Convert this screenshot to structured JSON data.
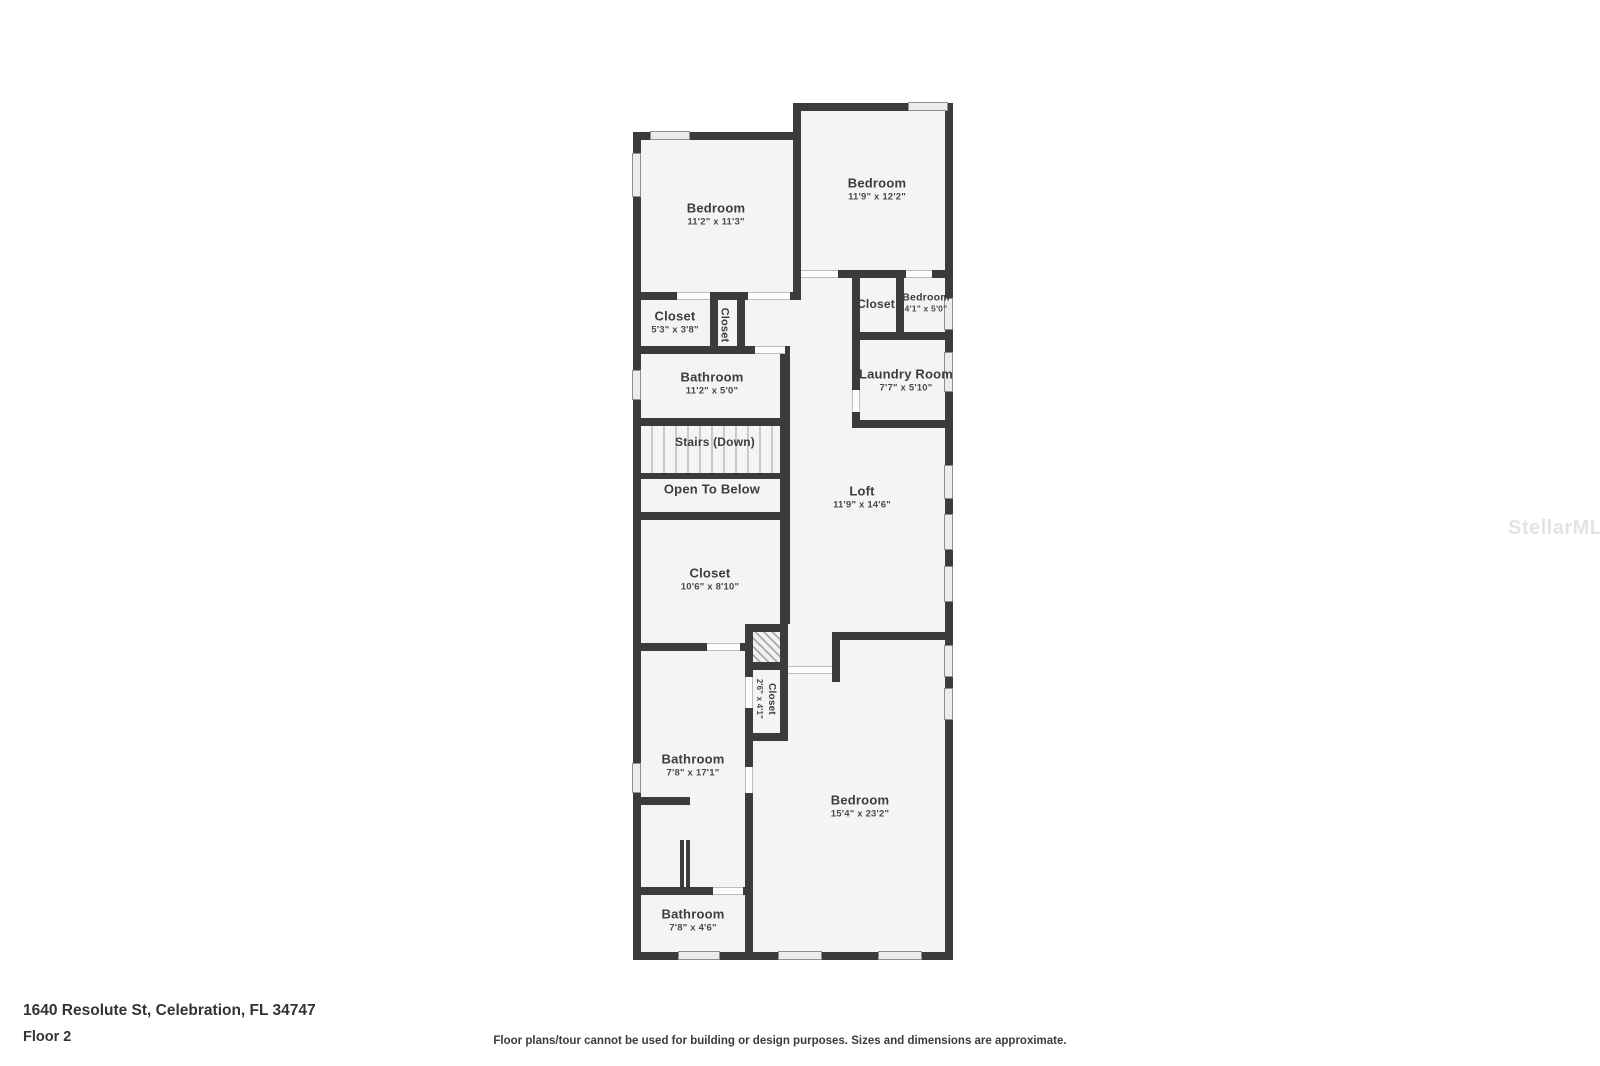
{
  "page": {
    "address": "1640 Resolute St, Celebration, FL 34747",
    "floor_label": "Floor 2",
    "disclaimer": "Floor plans/tour cannot be used for building or design purposes. Sizes and dimensions are approximate.",
    "watermark": "StellarMLS"
  },
  "colors": {
    "wall": "#3b3b3b",
    "room_fill": "#f4f4f4",
    "label_text": "#3d3d3d",
    "window_fill": "#ececec"
  },
  "rooms": [
    {
      "name": "Bedroom",
      "dims": "11'2\" x 11'3\""
    },
    {
      "name": "Bedroom",
      "dims": "11'9\" x 12'2\""
    },
    {
      "name": "Closet",
      "dims": "5'3\" x 3'8\""
    },
    {
      "name": "Closet",
      "dims": ""
    },
    {
      "name": "Closet",
      "dims": ""
    },
    {
      "name": "Bedroom",
      "dims": "4'1\" x 5'0\""
    },
    {
      "name": "Bathroom",
      "dims": "11'2\" x 5'0\""
    },
    {
      "name": "Laundry Room",
      "dims": "7'7\" x 5'10\""
    },
    {
      "name": "Stairs (Down)",
      "dims": ""
    },
    {
      "name": "Open To Below",
      "dims": ""
    },
    {
      "name": "Loft",
      "dims": "11'9\" x 14'6\""
    },
    {
      "name": "Closet",
      "dims": "10'6\" x 8'10\""
    },
    {
      "name": "Closet",
      "dims": "2'6\" x 4'1\""
    },
    {
      "name": "Bathroom",
      "dims": "7'8\" x 17'1\""
    },
    {
      "name": "Bedroom",
      "dims": "15'4\" x 23'2\""
    },
    {
      "name": "Bathroom",
      "dims": "7'8\" x 4'6\""
    }
  ]
}
